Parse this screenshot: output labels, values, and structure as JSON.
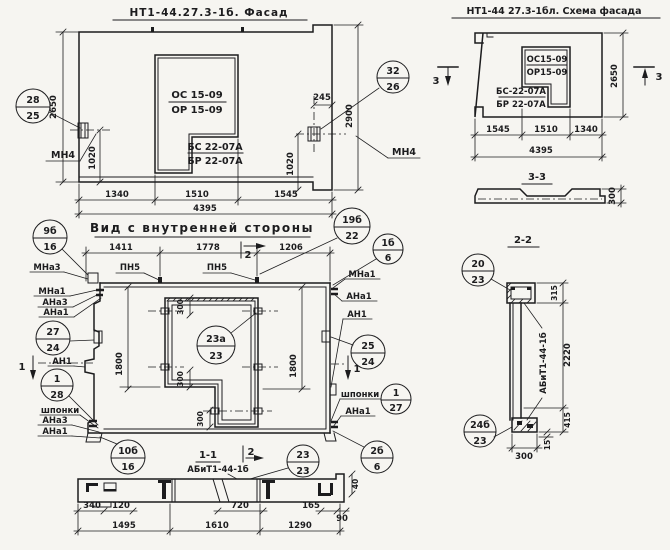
{
  "colors": {
    "paper": "#f6f5f1",
    "ink": "#1c1c1e"
  },
  "facade": {
    "title": "НТ1-44.27.3-1б. Фасад",
    "window": {
      "line1": "ОС 15-09",
      "line2": "ОР 15-09"
    },
    "sill": {
      "line1": "БС 22-07А",
      "line2": "БР 22-07А"
    },
    "ref_left": {
      "num": "28",
      "sheet": "25"
    },
    "ref_right": {
      "num": "32",
      "sheet": "26"
    },
    "anchor_left": "МН4",
    "anchor_right": "МН4",
    "dims": {
      "height2650": "2650",
      "height2900": "2900",
      "d245": "245",
      "left1020": "1020",
      "right1020": "1020",
      "w1340": "1340",
      "w1510": "1510",
      "w1545": "1545",
      "total": "4395"
    }
  },
  "scheme": {
    "title": "НТ1-44 27.3-1бл. Схема фасада",
    "window": {
      "line1": "ОС15-09",
      "line2": "ОР15-09"
    },
    "sill": {
      "line1": "БС-22-07А",
      "line2": "БР 22-07А"
    },
    "mark3": "3",
    "dims": {
      "height2650": "2650",
      "w1545": "1545",
      "w1510": "1510",
      "w1340": "1340",
      "total": "4395"
    }
  },
  "section33": {
    "title": "3-3",
    "dims": {
      "d300": "300"
    }
  },
  "inner": {
    "title": "Вид с внутренней стороны",
    "mark1": "1",
    "mark2": "2",
    "pn_left": "ПН5",
    "pn_right": "ПН5",
    "labels_left": {
      "mna3": "МНа3",
      "mna1": "МНа1",
      "ana3": "АНа3",
      "ana1": "АНа1",
      "an1": "АН1",
      "shponki": "шпонки",
      "ana3_b": "АНа3",
      "ana1_b": "АНа1"
    },
    "labels_right": {
      "mna1": "МНа1",
      "ana1": "АНа1",
      "an1": "АН1",
      "shponki": "шпонки",
      "ana1_b": "АНа1"
    },
    "refs": {
      "r9b16": {
        "num": "9б",
        "sheet": "16"
      },
      "r19b22": {
        "num": "19б",
        "sheet": "22"
      },
      "r1b6": {
        "num": "1б",
        "sheet": "6"
      },
      "r27_24": {
        "num": "27",
        "sheet": "24"
      },
      "r25_24": {
        "num": "25",
        "sheet": "24"
      },
      "r23a23": {
        "num": "23а",
        "sheet": "23"
      },
      "r1_28": {
        "num": "1",
        "sheet": "28"
      },
      "r1_27": {
        "num": "1",
        "sheet": "27"
      },
      "r10b16": {
        "num": "10б",
        "sheet": "16"
      },
      "r2b6": {
        "num": "2б",
        "sheet": "6"
      }
    },
    "dims": {
      "w1411": "1411",
      "w1778": "1778",
      "w1206": "1206",
      "h1800l": "1800",
      "h1800r": "1800",
      "d300a": "300",
      "d300b": "300",
      "d300c": "300"
    }
  },
  "section11": {
    "title": "1-1",
    "subtitle": "АБиТ1-44-1б",
    "mark2": "2",
    "ref": {
      "num": "23",
      "sheet": "23"
    },
    "dims": {
      "d340": "340",
      "d120": "120",
      "d720": "720",
      "d165": "165",
      "d90": "90",
      "d40": "40",
      "w1495": "1495",
      "w1610": "1610",
      "w1290": "1290"
    }
  },
  "section22": {
    "title": "2-2",
    "panel_mark": "АБиТ1-44-1б",
    "ref_top": {
      "num": "20",
      "sheet": "23"
    },
    "ref_bottom": {
      "num": "24б",
      "sheet": "23"
    },
    "dims": {
      "d315": "315",
      "d2220": "2220",
      "d415": "415",
      "d15": "15",
      "d300": "300"
    }
  }
}
